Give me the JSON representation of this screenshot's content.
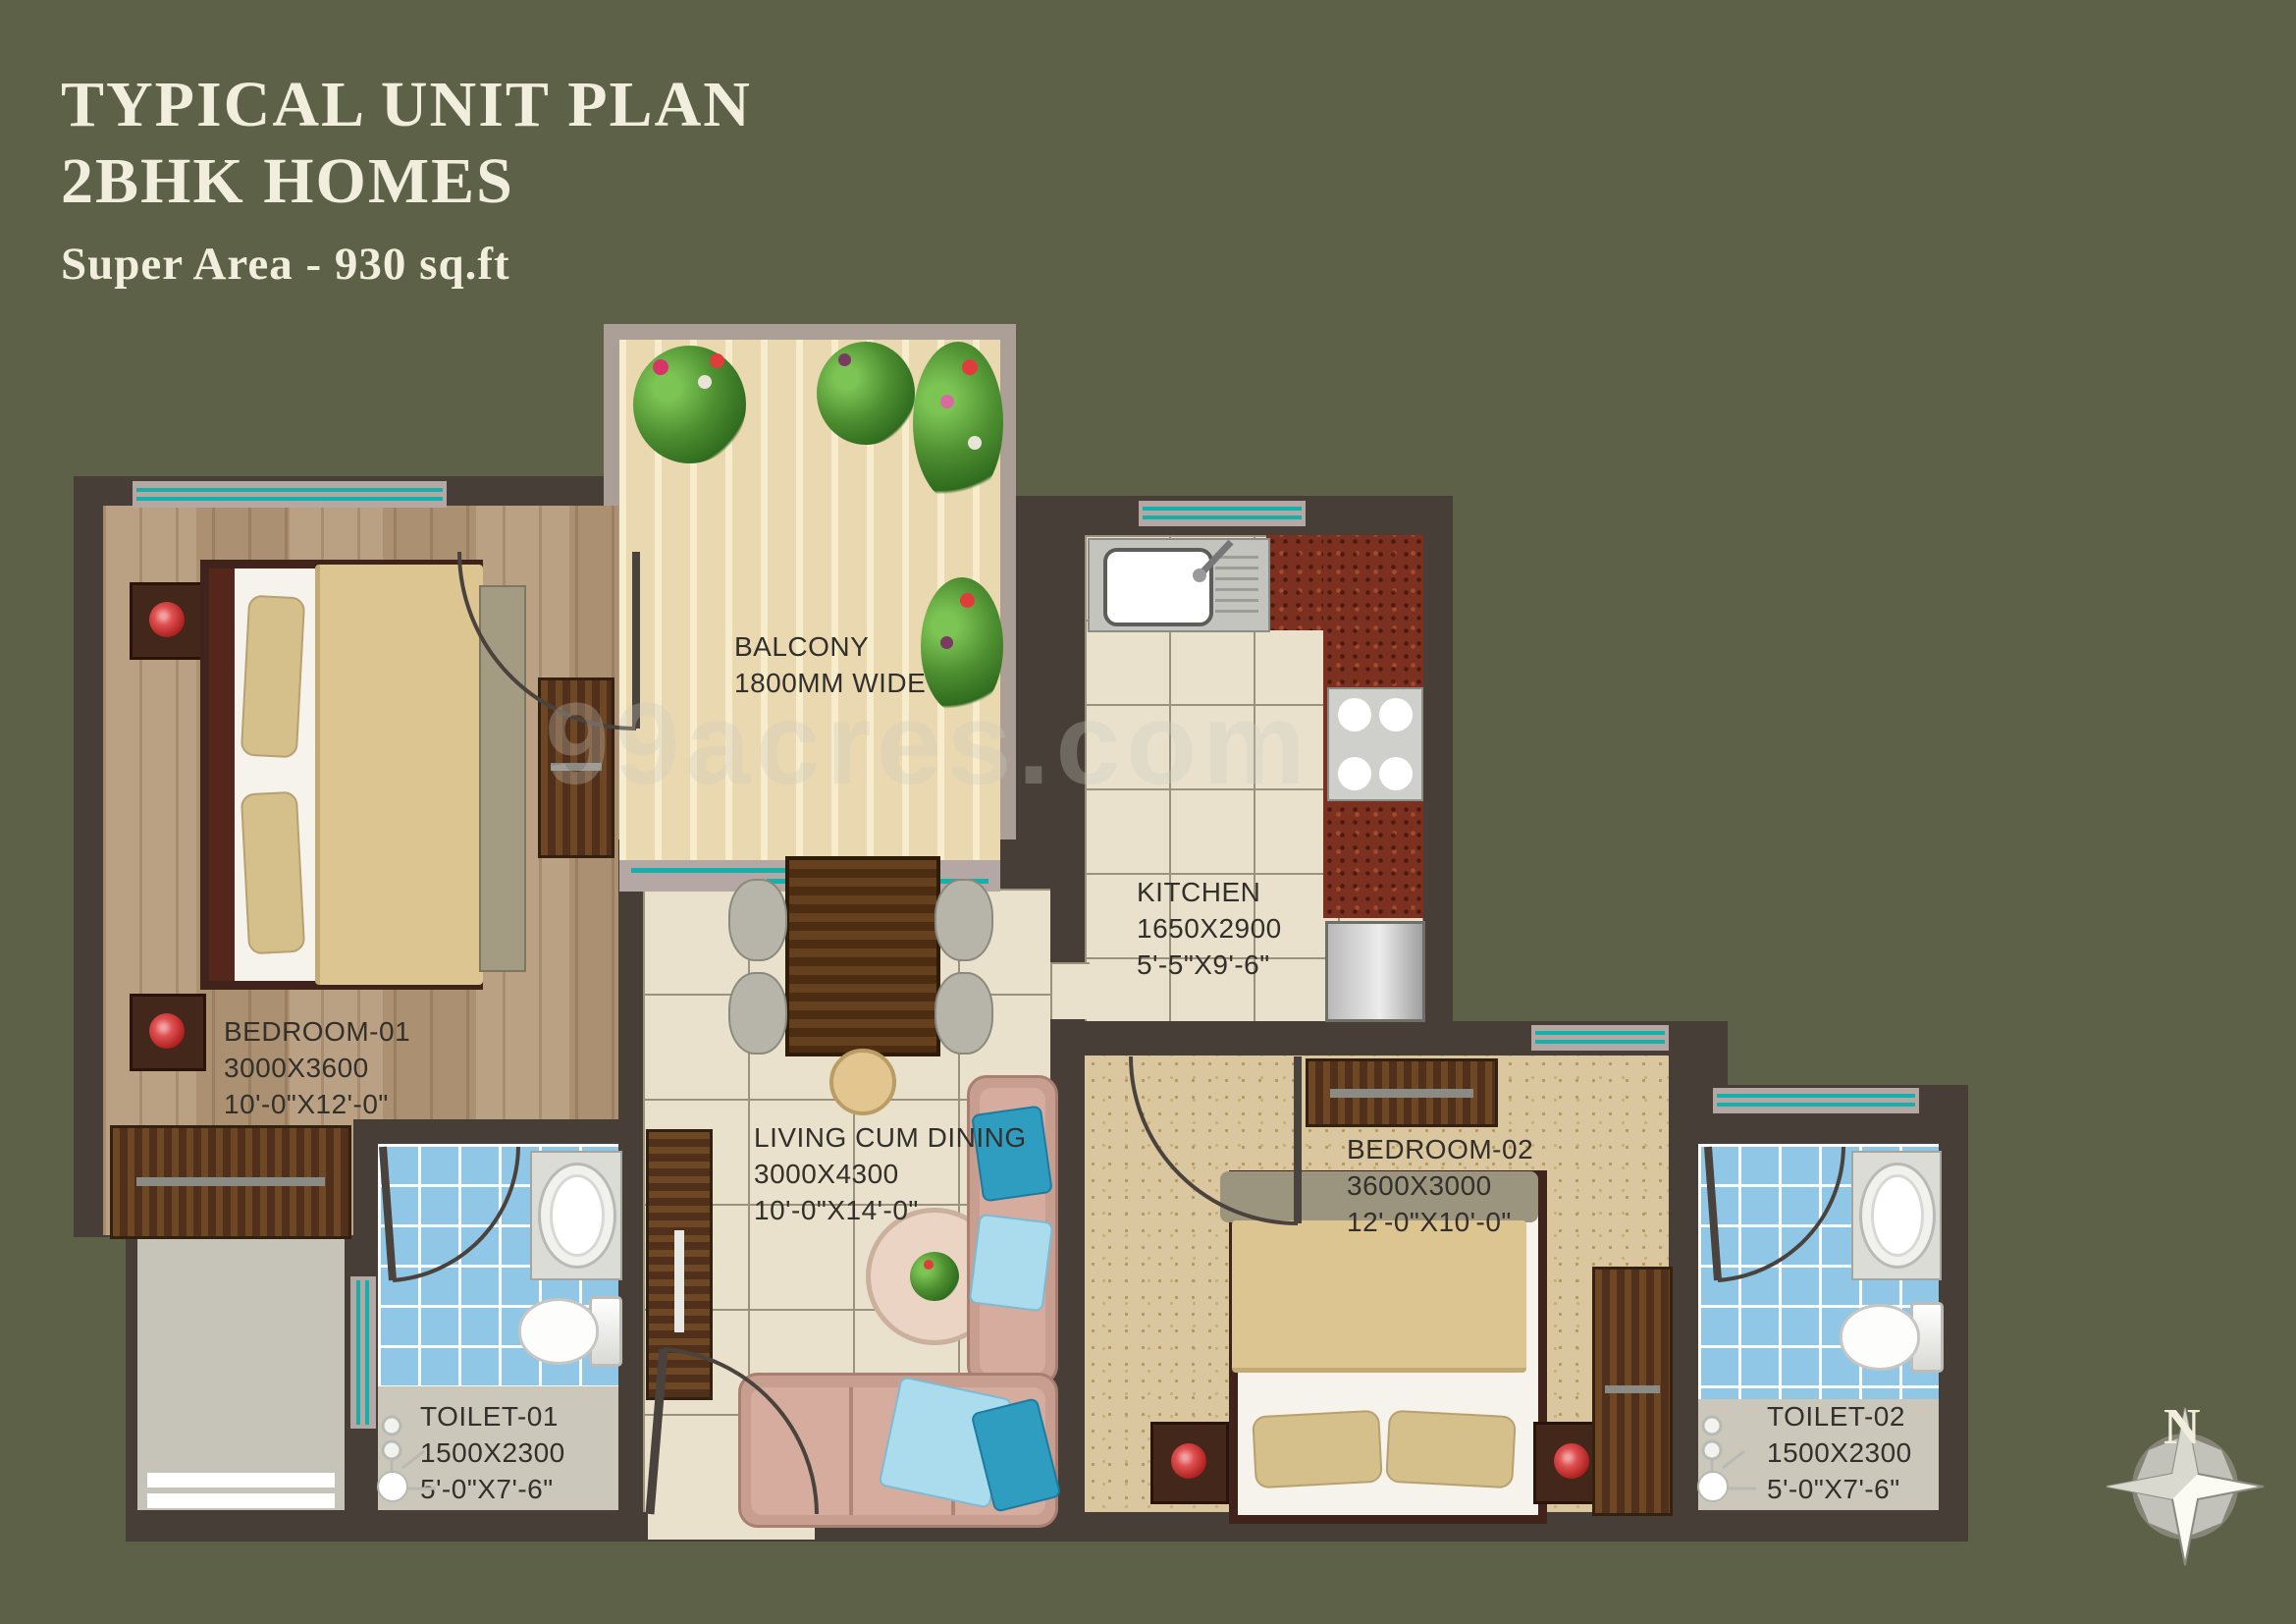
{
  "header": {
    "title_line1": "TYPICAL UNIT PLAN",
    "title_line2": "2BHK HOMES",
    "subtitle": "Super Area - 930 sq.ft"
  },
  "rooms": {
    "balcony": {
      "name": "BALCONY",
      "note": "1800MM WIDE"
    },
    "kitchen": {
      "name": "KITCHEN",
      "dim_mm": "1650X2900",
      "dim_ft": "5'-5\"X9'-6\""
    },
    "bedroom1": {
      "name": "BEDROOM-01",
      "dim_mm": "3000X3600",
      "dim_ft": "10'-0\"X12'-0\""
    },
    "living": {
      "name": "LIVING CUM DINING",
      "dim_mm": "3000X4300",
      "dim_ft": "10'-0\"X14'-0\""
    },
    "bedroom2": {
      "name": "BEDROOM-02",
      "dim_mm": "3600X3000",
      "dim_ft": "12'-0\"X10'-0\""
    },
    "toilet1": {
      "name": "TOILET-01",
      "dim_mm": "1500X2300",
      "dim_ft": "5'-0\"X7'-6\""
    },
    "toilet2": {
      "name": "TOILET-02",
      "dim_mm": "1500X2300",
      "dim_ft": "5'-0\"X7'-6\""
    }
  },
  "compass": {
    "label": "N"
  },
  "watermark": "99acres.com",
  "colors": {
    "background": "#5d6147",
    "wall": "#473e37",
    "window_teal": "#14b0ac",
    "title_text": "#f2eedd",
    "label_text": "#33302b"
  }
}
